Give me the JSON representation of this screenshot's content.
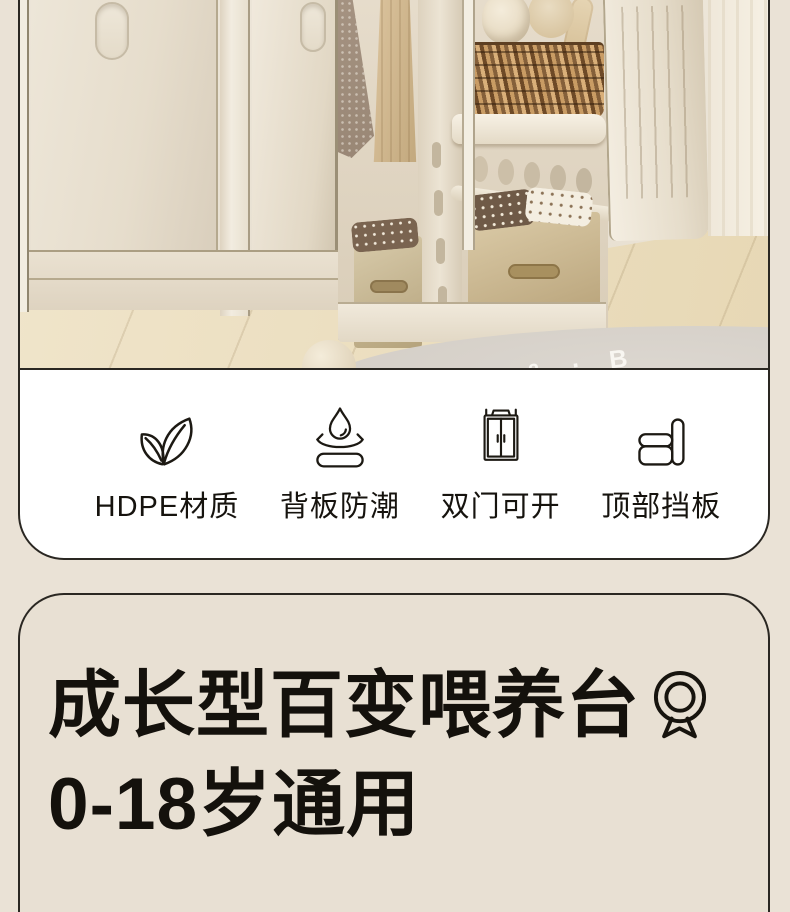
{
  "page": {
    "background_color": "#eae2d6",
    "outline_color": "#2a2722",
    "card_color": "#ffffff"
  },
  "hero": {
    "description": "Cream children's storage cabinets: closed door with slot handle, open doors showing hanging clothes, wicker basket with plush toys on a shelf, fabric storage bins, light wood floor with round grey rug and a small ball",
    "rug_text": "MOON · & · B"
  },
  "features": {
    "items": [
      {
        "id": "hdpe",
        "icon": "leaf-icon",
        "label": "HDPE材质"
      },
      {
        "id": "moisture",
        "icon": "water-drop-icon",
        "label": "背板防潮"
      },
      {
        "id": "doors",
        "icon": "double-door-cabinet-icon",
        "label": "双门可开"
      },
      {
        "id": "baffle",
        "icon": "top-baffle-icon",
        "label": "顶部挡板"
      }
    ]
  },
  "title_card": {
    "line1": "成长型百变喂养台",
    "line2": "0-18岁通用",
    "badge": "medal-icon"
  }
}
